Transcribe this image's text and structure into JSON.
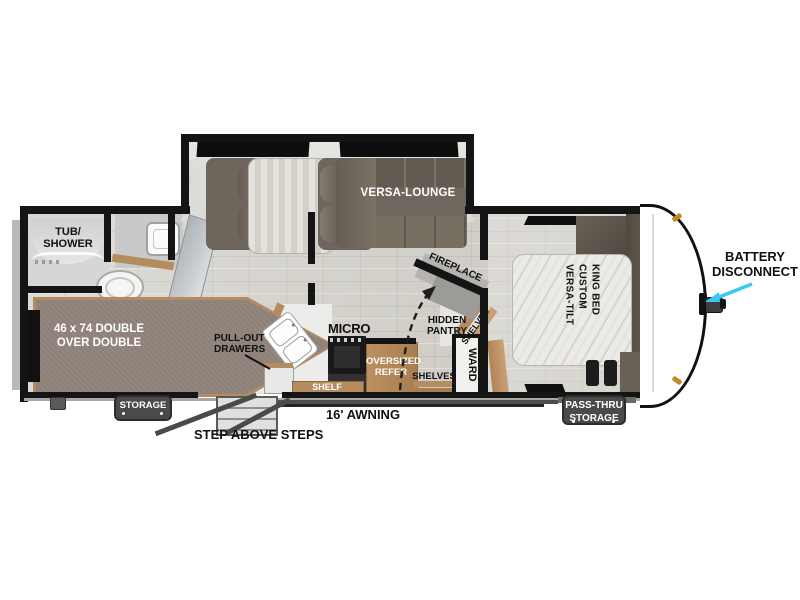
{
  "model_label": "26ICE",
  "colors": {
    "wall": "#141414",
    "floor_base": "#d4d1ca",
    "furniture_brown": "#6f675d",
    "wood_tan": "#b58c5f",
    "badge_gray": "#4a4a4a",
    "arrow_cyan": "#3cc7f3",
    "mattress_light": "#eceae5",
    "bunk_gray": "#8c8078"
  },
  "labels": {
    "tub_shower": {
      "line1": "TUB/",
      "line2": "SHOWER"
    },
    "bunk_bed": {
      "line1": "46 x 74 DOUBLE",
      "line2": "OVER DOUBLE"
    },
    "versa_lounge": "VERSA-LOUNGE",
    "fireplace": "FIREPLACE",
    "hidden_pantry": {
      "line1": "HIDDEN",
      "line2": "PANTRY"
    },
    "shelves_diagonal": "SHELVES",
    "shelves_lower": "SHELVES",
    "ward": "WARD",
    "micro": "MICRO",
    "pull_out_drawers": {
      "line1": "PULL-OUT",
      "line2": "DRAWERS"
    },
    "oversized_refer": {
      "line1": "OVERSIZED",
      "line2": "REFER"
    },
    "shelf": "SHELF",
    "king_bed": {
      "col1": "VERSA-TILT",
      "col2": "CUSTOM",
      "col3": "KING BED"
    },
    "closet": "CLOSET",
    "overhead": "OVERHEAD",
    "storage_badge": "STORAGE",
    "pass_thru": {
      "line1": "PASS-THRU",
      "line2": "STORAGE"
    },
    "awning": "16' AWNING",
    "step_above_steps": "STEP ABOVE STEPS",
    "battery_disconnect": {
      "line1": "BATTERY",
      "line2": "DISCONNECT"
    }
  }
}
